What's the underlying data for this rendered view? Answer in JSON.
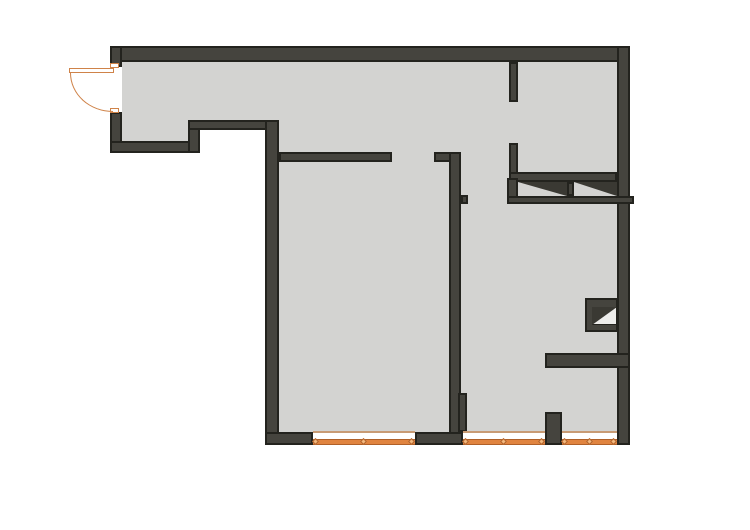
{
  "canvas": {
    "width": 750,
    "height": 530,
    "background": "#ffffff"
  },
  "palette": {
    "wall_fill": "#45443e",
    "wall_edge": "#23231e",
    "floor": "#d3d3d1",
    "window_orange": "#e08440",
    "window_orange_edge": "#b06028",
    "window_top_line": "#c89b74",
    "door_orange": "#cf8349",
    "shaft_inner": "#ededeb",
    "triangle": "#3a3933"
  },
  "floors": [
    {
      "name": "hallway-floor-left",
      "x": 122,
      "y": 62,
      "w": 66,
      "h": 79
    },
    {
      "name": "hallway-floor-mid",
      "x": 188,
      "y": 62,
      "w": 91,
      "h": 58
    },
    {
      "name": "main-floor",
      "x": 279,
      "y": 62,
      "w": 338,
      "h": 370
    }
  ],
  "walls": [
    {
      "name": "exterior-wall-top",
      "x": 110,
      "y": 46,
      "w": 520,
      "h": 16
    },
    {
      "name": "exterior-wall-right",
      "x": 617,
      "y": 46,
      "w": 13,
      "h": 399
    },
    {
      "name": "entry-wall-above-door",
      "x": 110,
      "y": 46,
      "w": 12,
      "h": 21
    },
    {
      "name": "entry-wall-below-door",
      "x": 110,
      "y": 112,
      "w": 12,
      "h": 41
    },
    {
      "name": "hallway-south-wall-left",
      "x": 110,
      "y": 141,
      "w": 90,
      "h": 12
    },
    {
      "name": "hallway-step-wall",
      "x": 188,
      "y": 120,
      "w": 12,
      "h": 33
    },
    {
      "name": "hallway-south-wall-mid",
      "x": 188,
      "y": 120,
      "w": 91,
      "h": 10
    },
    {
      "name": "exterior-wall-west",
      "x": 265,
      "y": 120,
      "w": 14,
      "h": 325
    },
    {
      "name": "leftroom-north-wall",
      "x": 279,
      "y": 152,
      "w": 113,
      "h": 10
    },
    {
      "name": "center-north-wall-corner",
      "x": 434,
      "y": 152,
      "w": 26,
      "h": 10
    },
    {
      "name": "center-vertical-wall",
      "x": 449,
      "y": 152,
      "w": 12,
      "h": 293
    },
    {
      "name": "center-wall-bump",
      "x": 461,
      "y": 195,
      "w": 7,
      "h": 9
    },
    {
      "name": "center-wall-pilaster",
      "x": 458,
      "y": 393,
      "w": 9,
      "h": 39
    },
    {
      "name": "wc-west-wall-upper",
      "x": 509,
      "y": 62,
      "w": 9,
      "h": 40
    },
    {
      "name": "wc-west-wall-lower",
      "x": 509,
      "y": 143,
      "w": 9,
      "h": 61
    },
    {
      "name": "shaft-band-top-wall",
      "x": 509,
      "y": 172,
      "w": 108,
      "h": 10
    },
    {
      "name": "shaft-band-left-stub",
      "x": 507,
      "y": 178,
      "w": 11,
      "h": 26
    },
    {
      "name": "shaft-band-bottom-wall",
      "x": 507,
      "y": 196,
      "w": 127,
      "h": 8
    },
    {
      "name": "shaft-band-divider",
      "x": 567,
      "y": 182,
      "w": 7,
      "h": 14
    },
    {
      "name": "small-shaft-frame",
      "x": 585,
      "y": 298,
      "w": 33,
      "h": 34
    },
    {
      "name": "rightroom-partition-wall",
      "x": 545,
      "y": 353,
      "w": 85,
      "h": 15
    },
    {
      "name": "window-pier",
      "x": 545,
      "y": 412,
      "w": 17,
      "h": 33
    },
    {
      "name": "bottom-wall-left-segment",
      "x": 265,
      "y": 432,
      "w": 48,
      "h": 13
    },
    {
      "name": "bottom-wall-mid-segment",
      "x": 415,
      "y": 432,
      "w": 48,
      "h": 13
    }
  ],
  "shaft_triangles": [
    {
      "name": "vent-shaft-a-hatch",
      "x": 518,
      "y": 182,
      "w": 49,
      "h": 14,
      "variant": "down-right"
    },
    {
      "name": "vent-shaft-b-hatch",
      "x": 574,
      "y": 182,
      "w": 43,
      "h": 14,
      "variant": "down-right"
    }
  ],
  "small_shaft": {
    "name": "small-vent-shaft-inner",
    "x": 592,
    "y": 307,
    "w": 25,
    "h": 18,
    "variant": "down-left"
  },
  "windows": [
    {
      "name": "window-left",
      "x": 313,
      "y": 431,
      "w": 102,
      "h": 14
    },
    {
      "name": "window-middle",
      "x": 463,
      "y": 431,
      "w": 82,
      "h": 14
    },
    {
      "name": "window-right",
      "x": 562,
      "y": 431,
      "w": 55,
      "h": 14
    }
  ],
  "door": {
    "opening": {
      "name": "entry-door-opening",
      "x": 110,
      "y": 67,
      "w": 12,
      "h": 45
    },
    "leaf": {
      "name": "entry-door-leaf",
      "x": 69,
      "y": 68,
      "w": 45,
      "h": 5
    },
    "arc": {
      "name": "entry-door-swing-arc",
      "x": 70,
      "y": 73,
      "w": 43,
      "h": 39
    },
    "jambs": [
      {
        "name": "entry-door-jamb-top",
        "x": 110,
        "y": 63,
        "w": 9,
        "h": 5
      },
      {
        "name": "entry-door-jamb-bottom",
        "x": 110,
        "y": 108,
        "w": 9,
        "h": 5
      }
    ]
  }
}
